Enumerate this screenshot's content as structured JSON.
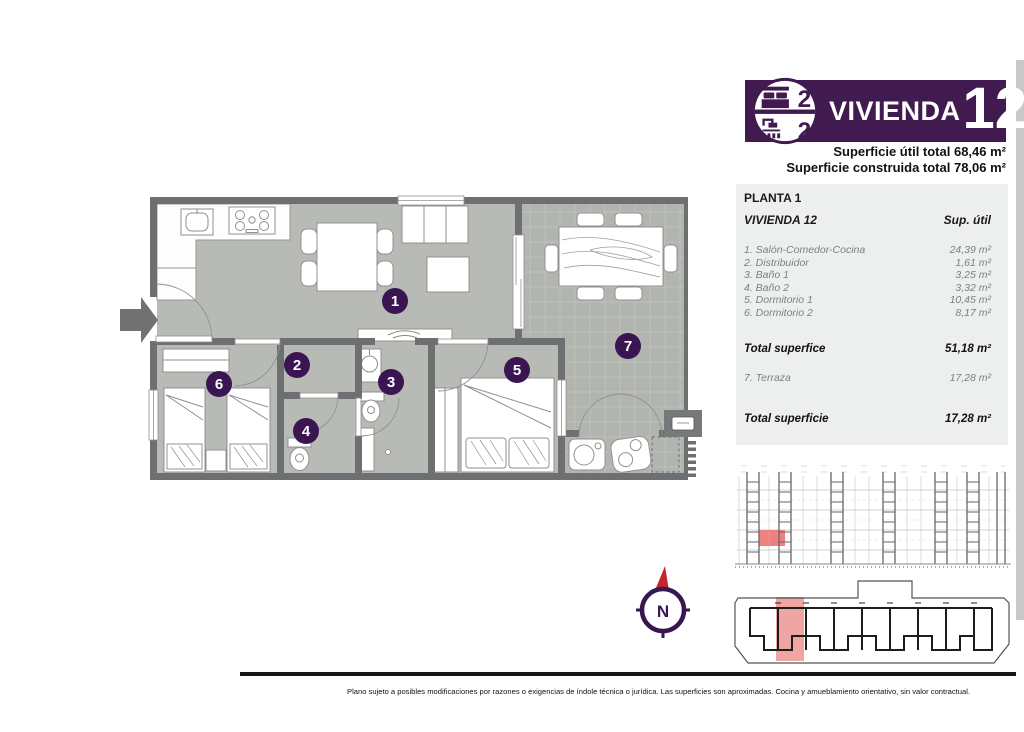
{
  "header": {
    "badge": {
      "bedrooms": "2",
      "bathrooms": "2"
    },
    "title": "VIVIENDA",
    "number": "12",
    "area_lines": {
      "util": "Superficie útil total 68,46 m²",
      "construida": "Superficie construida total 78,06 m²"
    }
  },
  "summary_table": {
    "floor_label": "PLANTA 1",
    "unit_label": "VIVIENDA 12",
    "column_header": "Sup. útil",
    "rows": [
      {
        "label": "1. Salón-Comedor-Cocina",
        "value": "24,39 m²"
      },
      {
        "label": "2. Distribuidor",
        "value": "1,61 m²"
      },
      {
        "label": "3. Baño 1",
        "value": "3,25 m²"
      },
      {
        "label": "4. Baño 2",
        "value": "3,32 m²"
      },
      {
        "label": "5. Dormitorio 1",
        "value": "10,45 m²"
      },
      {
        "label": "6. Dormitorio 2",
        "value": "8,17 m²"
      }
    ],
    "total_interior": {
      "label": "Total superfice",
      "value": "51,18 m²"
    },
    "terrace_row": {
      "label": "7. Terraza",
      "value": "17,28 m²"
    },
    "total_terrace": {
      "label": "Total superficie",
      "value": "17,28 m²"
    }
  },
  "floor_plan": {
    "room_labels": [
      "1",
      "2",
      "3",
      "4",
      "5",
      "6",
      "7"
    ]
  },
  "compass": {
    "north_label": "N"
  },
  "footer": {
    "disclaimer": "Plano sujeto a posibles modificaciones por razones o exigencias de índole técnica o jurídica. Las superficies son aproximadas. Cocina y amueblamiento orientativo, sin valor contractual."
  },
  "colors": {
    "brand_purple": "#411a4f",
    "marker_purple": "#3b1551",
    "accent_red": "#c4242b",
    "unit_highlight_pink": "#efa5a2",
    "elevation_highlight_red": "#f08080",
    "floor_gray": "#b8bbb5",
    "terrace_gray": "#b2b5af",
    "wall_gray": "#6e6f71",
    "table_bg": "#edefee"
  }
}
